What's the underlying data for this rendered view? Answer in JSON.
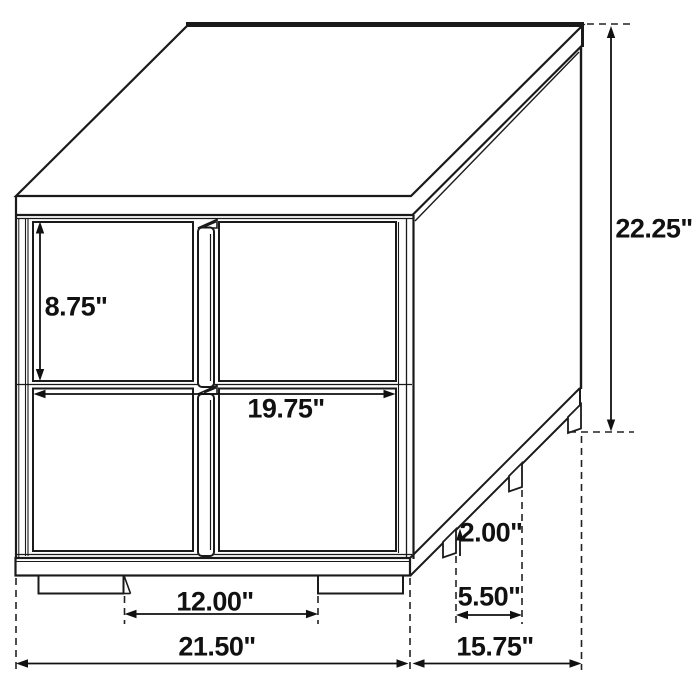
{
  "diagram": {
    "type": "furniture-dimension-line-drawing",
    "subject": "two-drawer nightstand shown in 3/4 isometric view with dimension arrows",
    "units": "inches",
    "line_color": "#1a1a1a",
    "background_color": "#ffffff"
  },
  "dimensions": {
    "drawer_front_height": "8.75\"",
    "drawer_front_width": "19.75\"",
    "overall_height": "22.25\"",
    "front_leg_spacing": "12.00\"",
    "overall_width": "21.50\"",
    "leg_height": "2.00\"",
    "side_leg_spacing": "5.50\"",
    "overall_depth": "15.75\""
  }
}
